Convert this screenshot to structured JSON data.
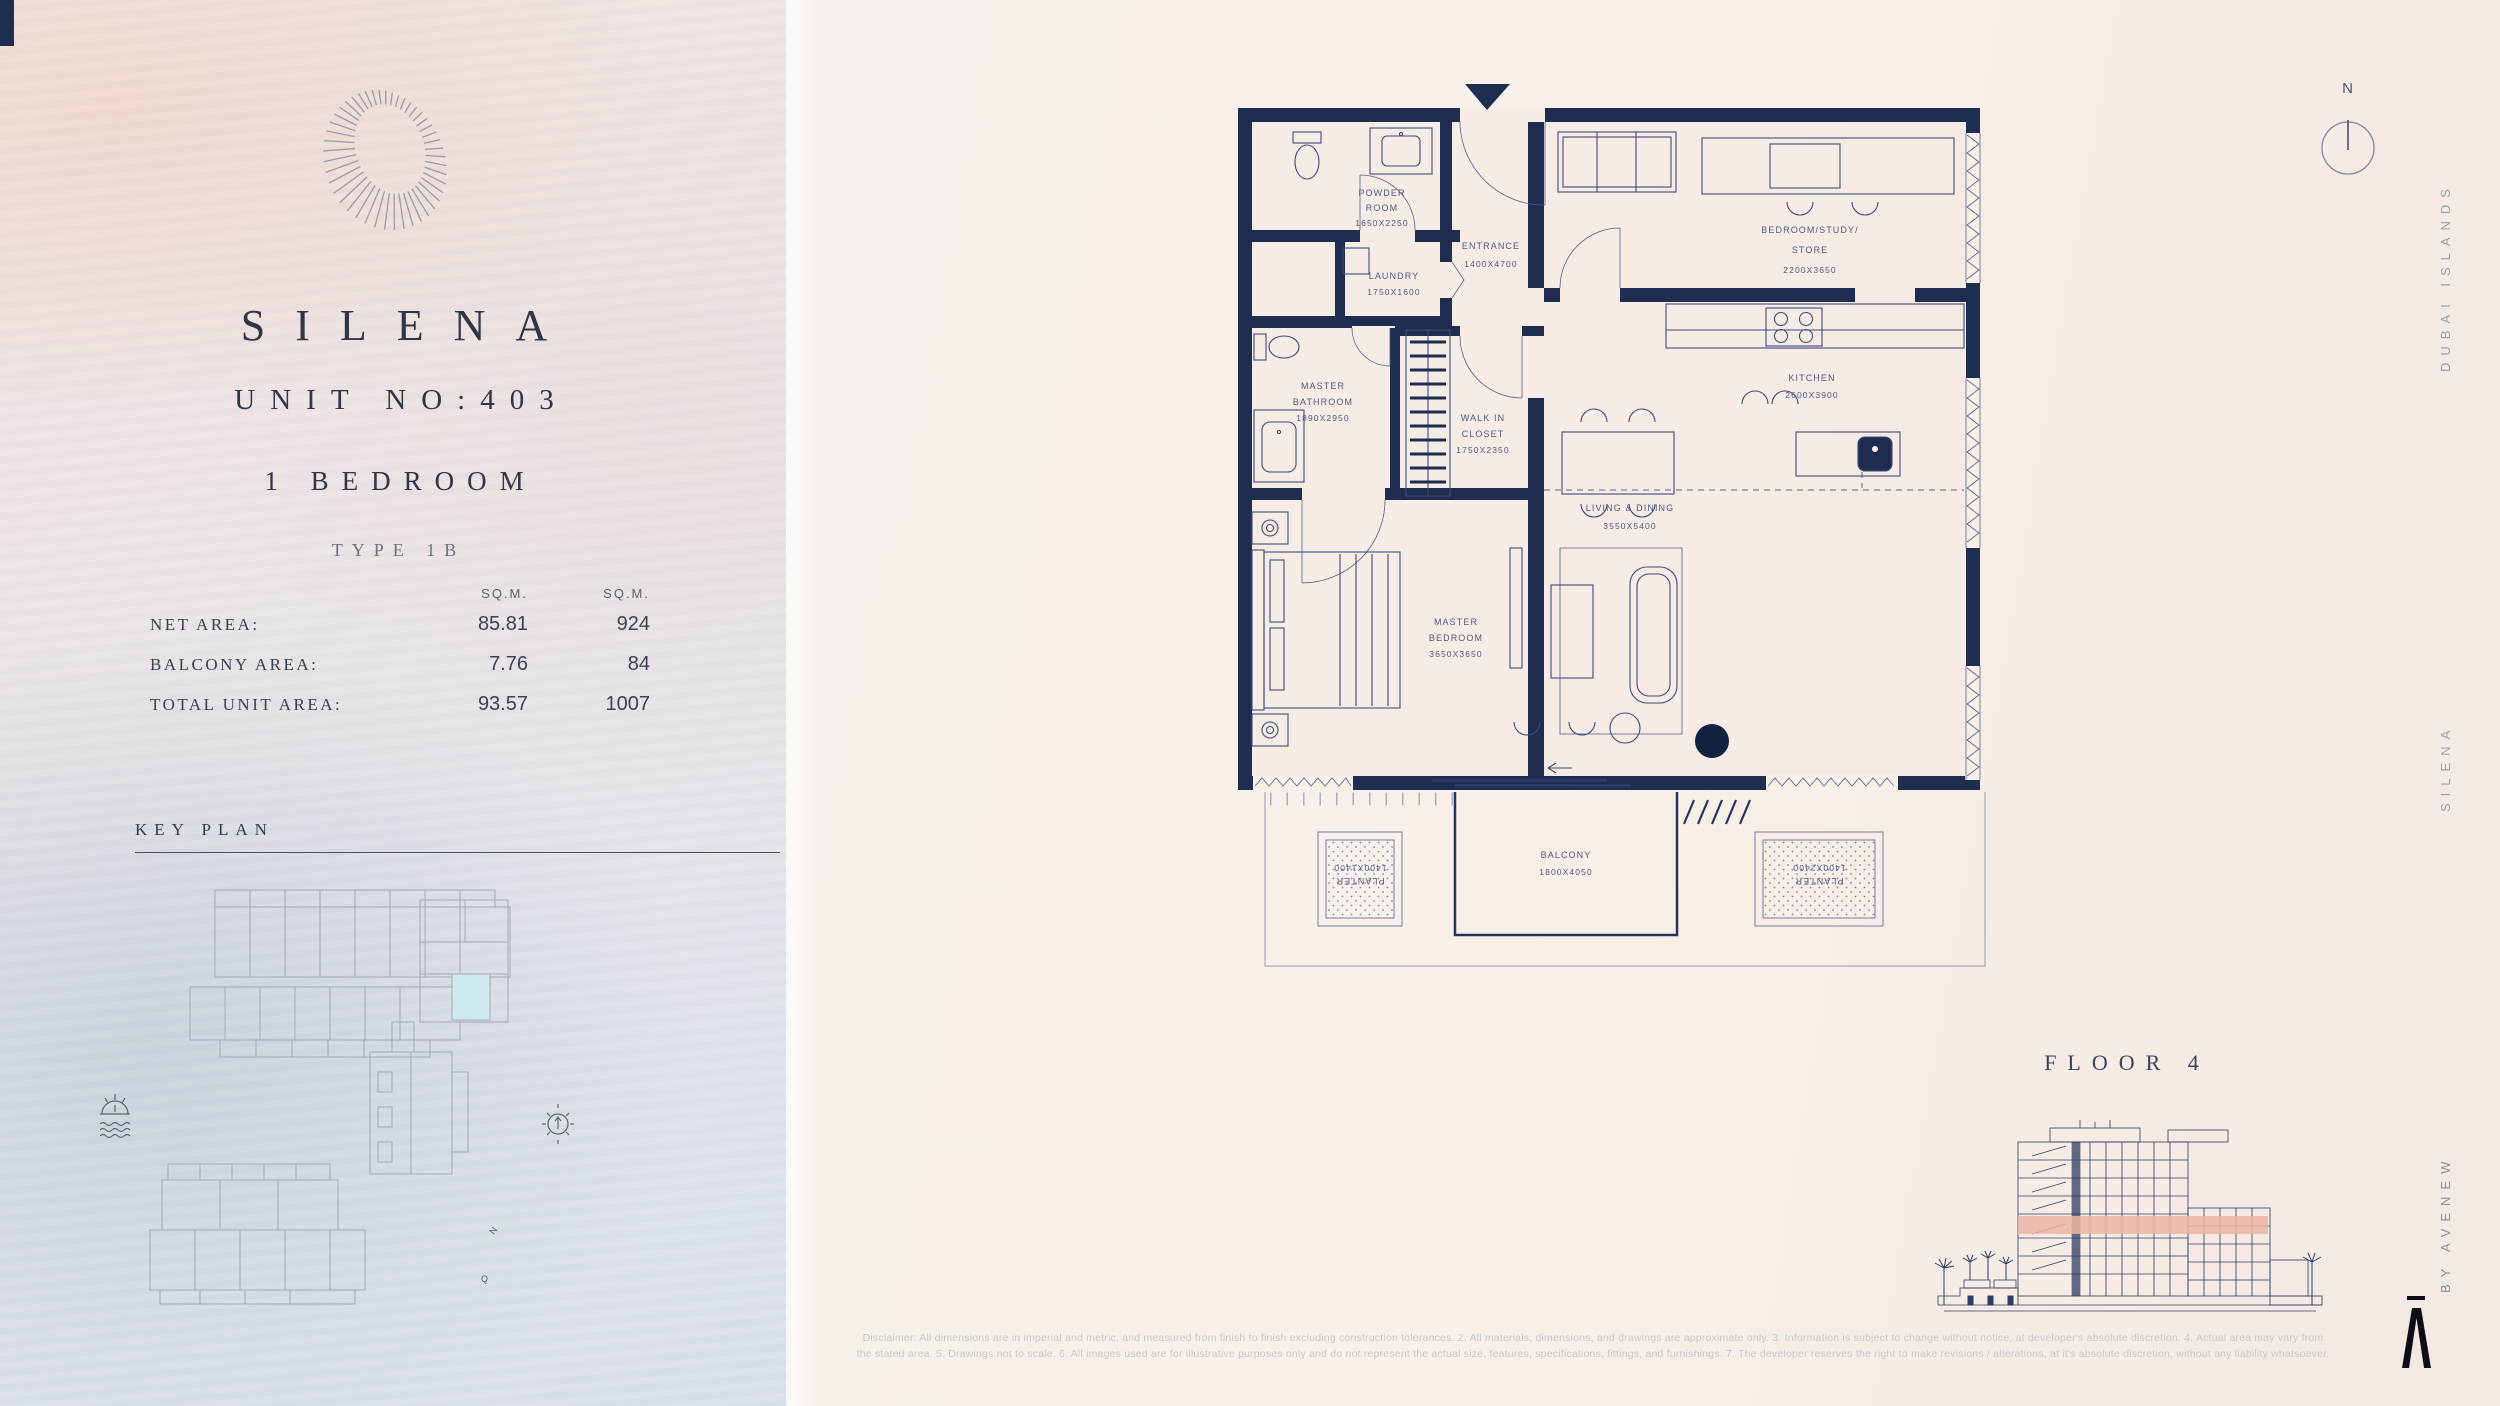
{
  "brand_panel": {
    "logo": "silena-spiral-logo",
    "title": "SILENA",
    "unit": "UNIT NO:403",
    "bedrooms": "1 BEDROOM",
    "type": "TYPE 1B",
    "areas": {
      "headers": [
        "SQ.M.",
        "SQ.M."
      ],
      "rows": [
        {
          "label": "NET AREA:",
          "v1": "85.81",
          "v2": "924"
        },
        {
          "label": "BALCONY AREA:",
          "v1": "7.76",
          "v2": "84"
        },
        {
          "label": "TOTAL UNIT AREA:",
          "v1": "93.57",
          "v2": "1007"
        }
      ]
    },
    "key_plan": {
      "title": "KEY PLAN",
      "north": "N",
      "q": "Q"
    }
  },
  "plan": {
    "rooms": [
      {
        "lines": [
          "POWDER",
          "ROOM"
        ],
        "dim": "1650X2250"
      },
      {
        "lines": [
          "LAUNDRY"
        ],
        "dim": "1750X1600"
      },
      {
        "lines": [
          "ENTRANCE"
        ],
        "dim": "1400X4700"
      },
      {
        "lines": [
          "BEDROOM/STUDY/",
          "STORE"
        ],
        "dim": "2200X3650"
      },
      {
        "lines": [
          "KITCHEN"
        ],
        "dim": "2600X3900"
      },
      {
        "lines": [
          "MASTER",
          "BATHROOM"
        ],
        "dim": "1890X2950"
      },
      {
        "lines": [
          "WALK IN",
          "CLOSET"
        ],
        "dim": "1750X2350"
      },
      {
        "lines": [
          "MASTER",
          "BEDROOM"
        ],
        "dim": "3650X3650"
      },
      {
        "lines": [
          "LIVING & DINING"
        ],
        "dim": "3550X5400"
      },
      {
        "lines": [
          "BALCONY"
        ],
        "dim": "1800X4050"
      },
      {
        "lines": [
          "PLANTER"
        ],
        "dim": "1400X1400"
      },
      {
        "lines": [
          "PLANTER"
        ],
        "dim": "1400X2400"
      }
    ]
  },
  "rail": {
    "top": "DUBAI ISLANDS",
    "mid": "SILENA",
    "bottom": "BY AVENEW",
    "compass": "N"
  },
  "elevation": {
    "title": "FLOOR 4"
  },
  "disclaimer": {
    "line1": "Disclaimer: All dimensions are in imperial and metric, and measured from finish to finish excluding construction tolerances. 2. All materials, dimensions, and drawings are approximate only. 3. Information is subject to change without notice, at developer's absolute discretion. 4. Actual area may vary from",
    "line2": "the stated area. 5. Drawings not to scale. 6. All images used are for illustrative purposes only and do not represent the actual size, features, specifications, fittings, and furnishings. 7. The developer reserves the right to make revisions / alterations, at it's absolute discretion, without any liability whatsoever."
  },
  "colors": {
    "wall": "#1e2d50",
    "floor_highlight": "#ecb5a4",
    "keyplan_highlight": "#cde9ef"
  }
}
